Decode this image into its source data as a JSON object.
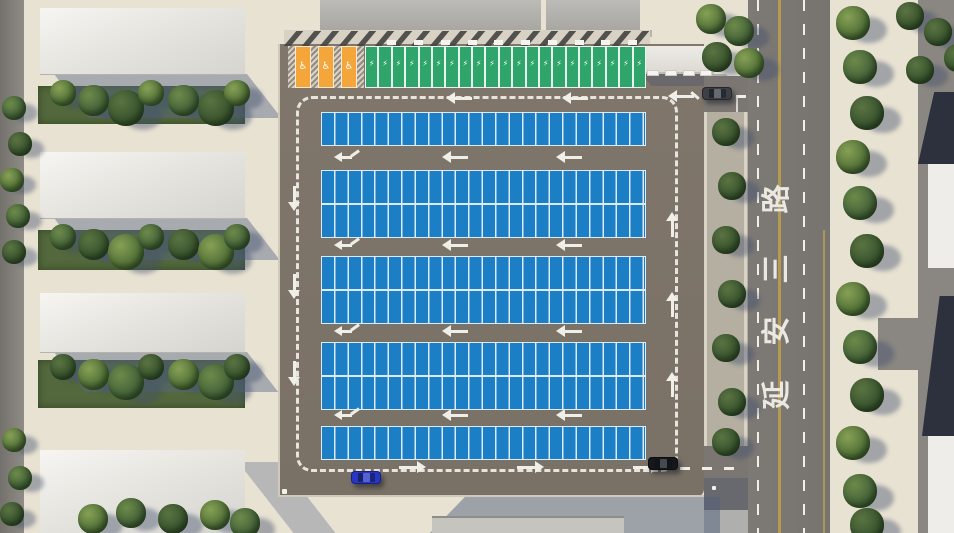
{
  "scene": {
    "type": "3d-aerial-parking-lot-simulation",
    "road": {
      "name": "延安三路",
      "name_chars": [
        "路",
        "三",
        "安",
        "延"
      ],
      "center_line_color": "#b49b51",
      "lane_marking_color": "#f0efe7",
      "asphalt_color": "#7b7773"
    },
    "parking_lot": {
      "asphalt_color": "#7d7469",
      "perimeter_marking": "dashed-white",
      "circulation": "counterclockwise",
      "standard_rows": 8,
      "stalls_per_row": 24,
      "standard_stall_color": "#1c7ec4",
      "stall_line_color": "#dcebf8",
      "ev_stall_count": 21,
      "ev_stall_color": "#2fa56b",
      "ev_stall_symbol": "⚡",
      "accessible_stall_count": 3,
      "accessible_stall_color": "#f4a63b",
      "accessible_stall_symbol": "♿"
    },
    "vehicles": [
      {
        "name": "blue-car",
        "color": "#2836c6",
        "x": 351,
        "y": 471,
        "heading": "east"
      },
      {
        "name": "black-car",
        "color": "#15171b",
        "x": 648,
        "y": 457,
        "heading": "east"
      },
      {
        "name": "gray-car",
        "color": "#3c4046",
        "x": 702,
        "y": 87,
        "heading": "west"
      }
    ],
    "environment": {
      "buildings_left": 4,
      "tree_color": "#4c6a33",
      "sidewalk_color": "#e8e2d2",
      "building_roof_color": "#f1f0ec",
      "dark_roof_color": "#2c313d"
    }
  }
}
